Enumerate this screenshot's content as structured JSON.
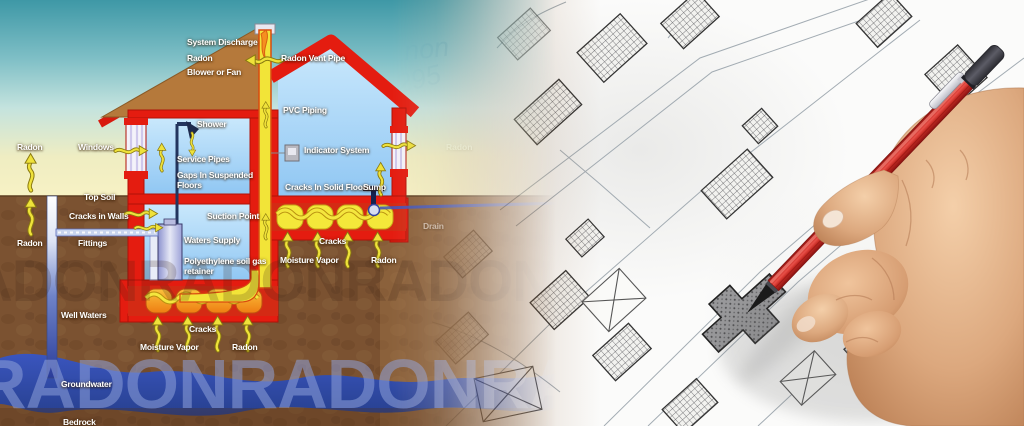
{
  "diagram": {
    "labels": {
      "system_discharge": "System Discharge",
      "radon_top": "Radon",
      "blower_or_fan": "Blower or Fan",
      "radon_vent_pipe": "Radon Vent Pipe",
      "pvc_piping": "PVC Piping",
      "shower": "Shower",
      "indicator_system": "Indicator System",
      "radon_left_upper": "Radon",
      "windows": "Windows",
      "service_pipes": "Service Pipes",
      "gaps_in_suspended_floors": "Gaps In Suspended Floors",
      "top_soil": "Top Soil",
      "cracks_in_walls": "Cracks in Walls",
      "cracks_in_solid_floors": "Cracks In Solid Floors",
      "sump": "Sump",
      "suction_point": "Suction Point",
      "drain": "Drain",
      "radon_left_lower": "Radon",
      "fittings": "Fittings",
      "waters_supply": "Waters Supply",
      "polyethylene_soil_gas_retainer": "Polyethylene soil gas retainer",
      "cracks_right": "Cracks",
      "moisture_vapor_right": "Moisture Vapor",
      "radon_right": "Radon",
      "well_waters": "Well Waters",
      "cracks_bottom": "Cracks",
      "moisture_vapor_bottom": "Moisture Vapor",
      "radon_bottom": "Radon",
      "groundwater": "Groundwater",
      "bedrock": "Bedrock"
    },
    "watermark": "RADON"
  },
  "map": {
    "faded_annotations": {
      "handwriting_1": "non",
      "handwriting_2": "295",
      "radon_faded": "Radon"
    }
  },
  "colors": {
    "wall_red": "#e41c10",
    "roof_brown": "#b5793b",
    "interior_blue": "#a9d4f7",
    "soil_brown": "#7b5231",
    "groundwater_blue": "#2e46a8",
    "vent_pipe_yellow": "#f2e438",
    "arrow_yellow": "#efe23a",
    "pencil_red": "#c62b24",
    "hand_skin": "#d9a583",
    "map_line_gray": "#9aa4ac"
  }
}
